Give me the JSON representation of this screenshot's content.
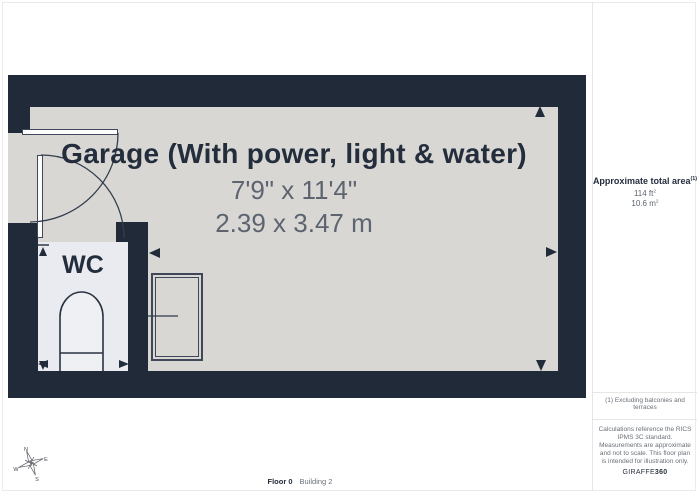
{
  "colors": {
    "wall": "#212a38",
    "garage_floor": "#d8d7d4",
    "wc_floor": "#e9ebf0",
    "title_text": "#242d3c",
    "dim_text": "#5d6470",
    "muted_text": "#6a7078",
    "linework": "#3e4859",
    "divider": "#e6e6e6"
  },
  "plan": {
    "room_title": "Garage (With power, light & water)",
    "room_dims_imperial": "7'9\" x 11'4\"",
    "room_dims_metric": "2.39 x 3.47 m",
    "wc_label": "WC",
    "compass": {
      "n": "N",
      "e": "E",
      "s": "S",
      "w": "W"
    }
  },
  "sidebar": {
    "area_title": "Approximate total area",
    "area_title_sup": "(1)",
    "area_imperial_value": "114 ft",
    "area_imperial_sup": "2",
    "area_metric_value": "10.6 m",
    "area_metric_sup": "2",
    "footnote": "(1) Excluding balconies and terraces",
    "disclaimer": "Calculations reference the RICS IPMS 3C standard. Measurements are approximate and not to scale. This floor plan is intended for illustration only.",
    "brand_name": "GIRAFFE",
    "brand_suffix": "360"
  },
  "footer": {
    "floor_label": "Floor 0",
    "building_label": "Building 2"
  }
}
